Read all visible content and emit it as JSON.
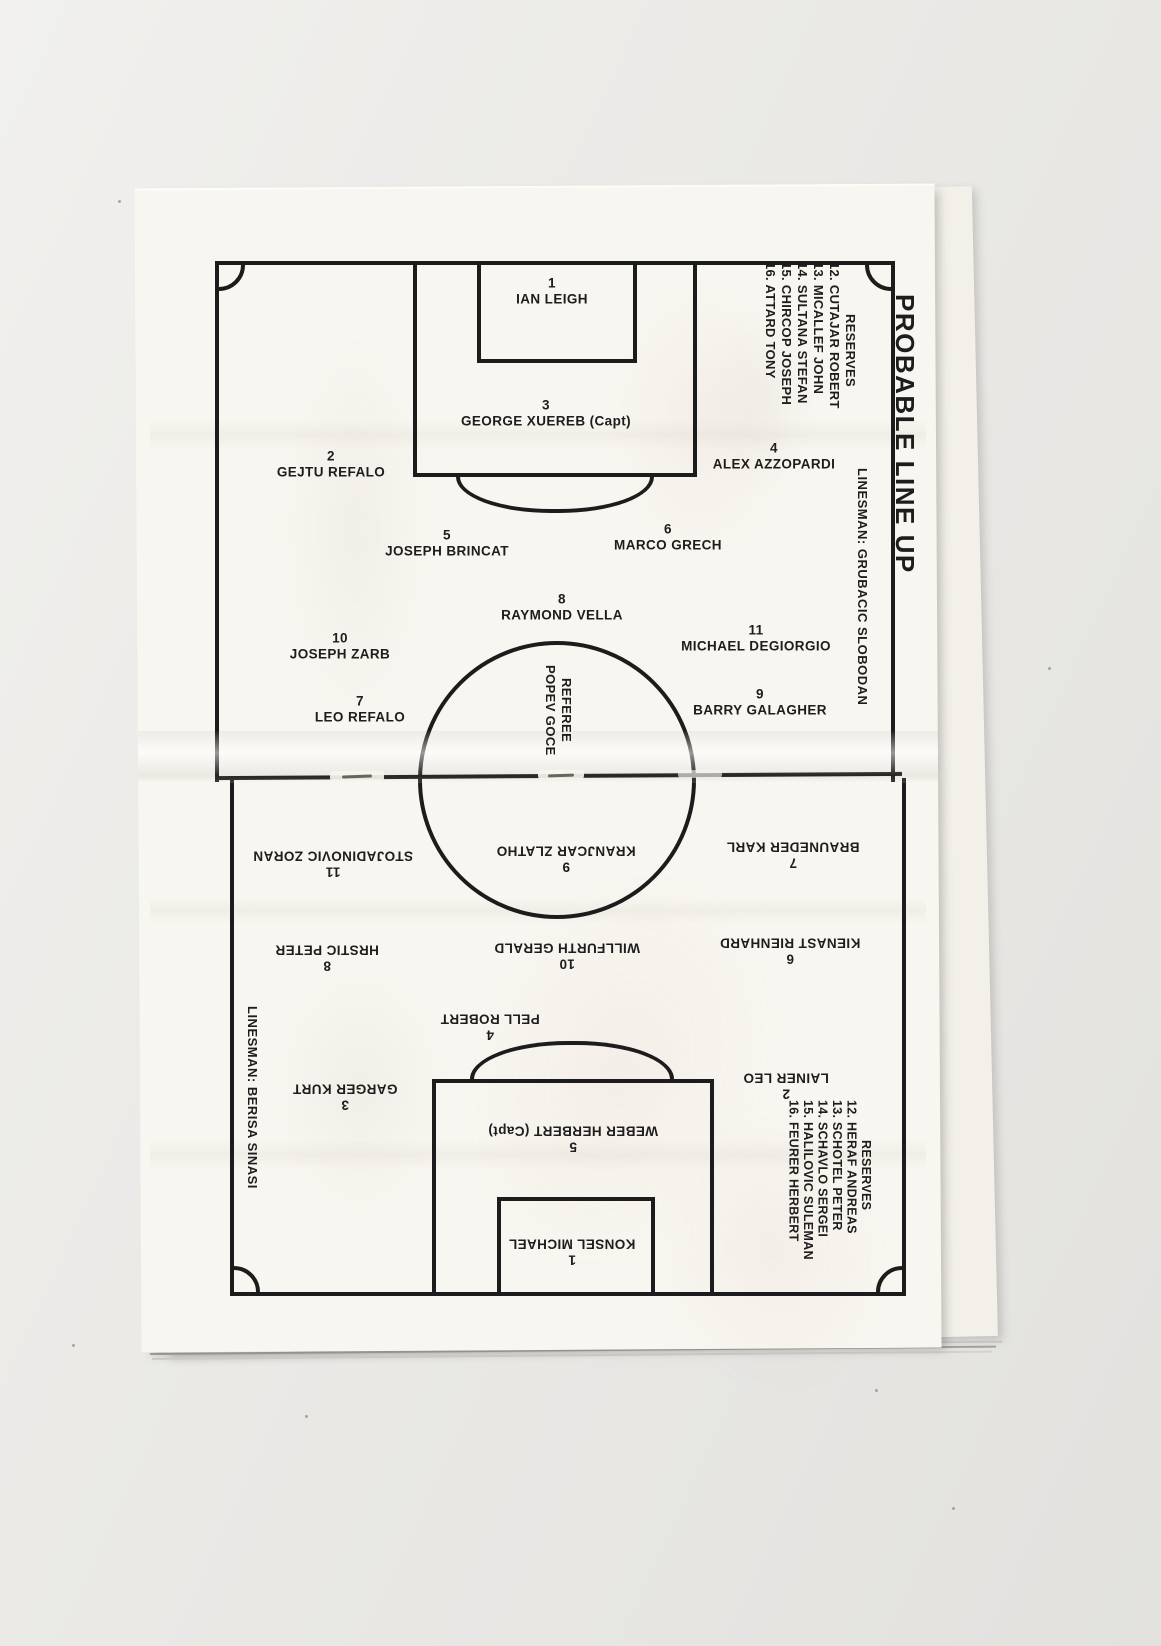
{
  "page": {
    "title": "PROBABLE LINE UP"
  },
  "colors": {
    "ink": "#1c1c1c",
    "paper": "#f8f6f0"
  },
  "referee": {
    "label": "REFEREE",
    "name": "POPEV GOCE"
  },
  "home_team": {
    "linesman": "LINESMAN: GRUBACIC SLOBODAN",
    "reserves_title": "RESERVES",
    "reserves": [
      "12. CUTAJAR ROBERT",
      "13. MICALLEF JOHN",
      "14. SULTANA STEFAN",
      "15. CHIRCOP JOSEPH",
      "16. ATTARD TONY"
    ],
    "players": [
      {
        "number": "1",
        "name": "IAN LEIGH",
        "x": 552,
        "y": 291
      },
      {
        "number": "3",
        "name": "GEORGE XUEREB (Capt)",
        "x": 546,
        "y": 413
      },
      {
        "number": "2",
        "name": "GEJTU REFALO",
        "x": 331,
        "y": 464
      },
      {
        "number": "4",
        "name": "ALEX AZZOPARDI",
        "x": 774,
        "y": 456
      },
      {
        "number": "5",
        "name": "JOSEPH BRINCAT",
        "x": 447,
        "y": 543
      },
      {
        "number": "6",
        "name": "MARCO GRECH",
        "x": 668,
        "y": 537
      },
      {
        "number": "8",
        "name": "RAYMOND VELLA",
        "x": 562,
        "y": 607
      },
      {
        "number": "10",
        "name": "JOSEPH ZARB",
        "x": 340,
        "y": 646
      },
      {
        "number": "11",
        "name": "MICHAEL DEGIORGIO",
        "x": 756,
        "y": 638
      },
      {
        "number": "7",
        "name": "LEO REFALO",
        "x": 360,
        "y": 709
      },
      {
        "number": "9",
        "name": "BARRY GALAGHER",
        "x": 760,
        "y": 702
      }
    ]
  },
  "away_team": {
    "linesman": "LINESMAN: BERISA SINASI",
    "reserves_title": "RESERVES",
    "reserves": [
      "12. HERAF ANDREAS",
      "13. SCHOTEL PETER",
      "14. SCHAVLO SERGEI",
      "15. HALILOVIC SULEMAN",
      "16. FEURER HERBERT"
    ],
    "players": [
      {
        "number": "9",
        "name": "KRANJCAR ZLATHO",
        "x": 566,
        "y": 859
      },
      {
        "number": "11",
        "name": "STOJADINOVIC ZORAN",
        "x": 333,
        "y": 864
      },
      {
        "number": "7",
        "name": "BRAUNEDER KARL",
        "x": 793,
        "y": 855
      },
      {
        "number": "8",
        "name": "HRSTIC PETER",
        "x": 327,
        "y": 958
      },
      {
        "number": "10",
        "name": "WILLFURTH GERALD",
        "x": 567,
        "y": 956
      },
      {
        "number": "6",
        "name": "KIENAST RIENHARD",
        "x": 790,
        "y": 951
      },
      {
        "number": "4",
        "name": "PELL ROBERT",
        "x": 490,
        "y": 1027
      },
      {
        "number": "2",
        "name": "LAINER LEO",
        "x": 786,
        "y": 1086
      },
      {
        "number": "3",
        "name": "GARGER KURT",
        "x": 345,
        "y": 1097
      },
      {
        "number": "5",
        "name": "WEBER HERBERT (Capt)",
        "x": 573,
        "y": 1139
      },
      {
        "number": "1",
        "name": "KONSEL MICHAEL",
        "x": 572,
        "y": 1252
      }
    ]
  }
}
